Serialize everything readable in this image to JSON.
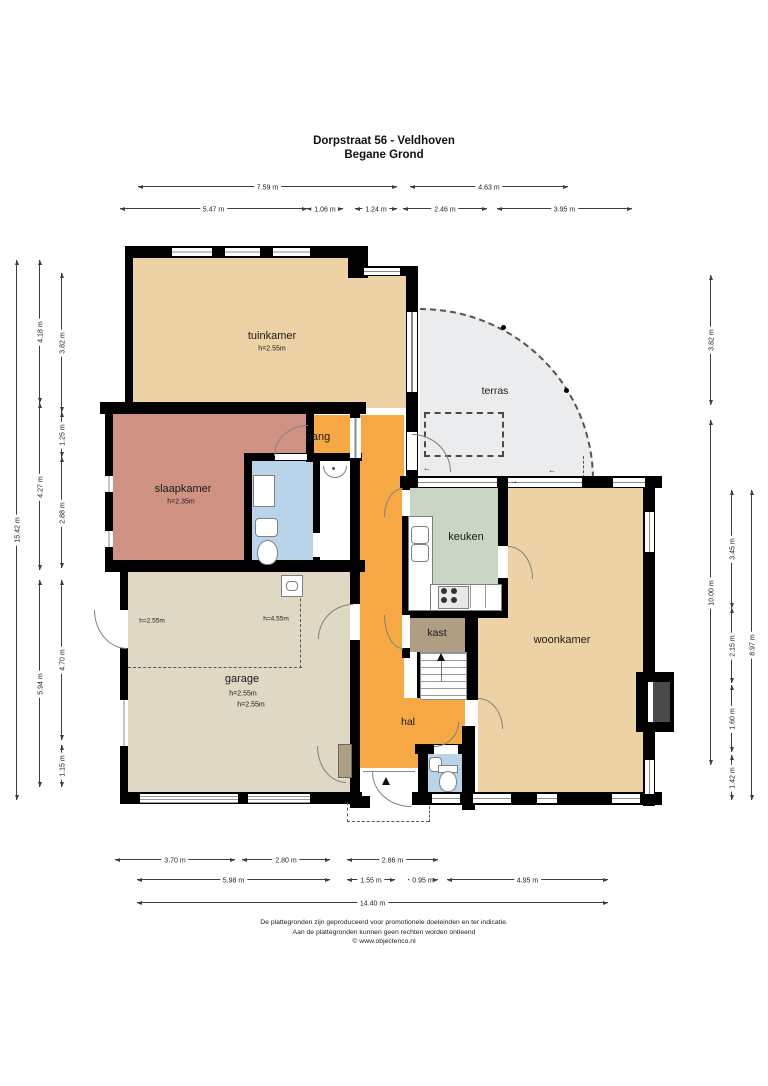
{
  "title": {
    "line1": "Dorpstraat 56 - Veldhoven",
    "line2": "Begane Grond"
  },
  "footer": {
    "line1": "De plattegronden zijn geproduceerd voor promotionele doeleinden en ter indicatie.",
    "line2": "Aan de plattegronden kunnen geen rechten worden ontleend",
    "line3": "© www.objectenco.nl"
  },
  "colors": {
    "beige": "#ecd2a4",
    "salmon": "#d09383",
    "orange": "#f5a844",
    "sage": "#cbd5c5",
    "greige": "#ded8c4",
    "brown": "#ae9f83",
    "blue": "#b9d4e9",
    "terras": "#ebecee",
    "wall": "#000000"
  },
  "plan": {
    "labels": [
      {
        "name": "room-label-tuinkamer",
        "text": "tuinkamer",
        "x": 272,
        "y": 336,
        "fs": 11
      },
      {
        "name": "room-height-tuinkamer",
        "text": "h=2.55m",
        "x": 272,
        "y": 349,
        "fs": 7
      },
      {
        "name": "room-label-terras",
        "text": "terras",
        "x": 495,
        "y": 391,
        "fs": 10.5
      },
      {
        "name": "room-label-gang",
        "text": "gang",
        "x": 318,
        "y": 437,
        "fs": 11
      },
      {
        "name": "room-label-slaapkamer",
        "text": "slaapkamer",
        "x": 183,
        "y": 489,
        "fs": 11
      },
      {
        "name": "room-height-slaapkamer",
        "text": "h=2.35m",
        "x": 181,
        "y": 502,
        "fs": 7
      },
      {
        "name": "room-label-keuken",
        "text": "keuken",
        "x": 466,
        "y": 537,
        "fs": 11
      },
      {
        "name": "room-label-kast",
        "text": "kast",
        "x": 437,
        "y": 633,
        "fs": 10.5
      },
      {
        "name": "room-label-woonkamer",
        "text": "woonkamer",
        "x": 562,
        "y": 640,
        "fs": 11
      },
      {
        "name": "room-label-garage",
        "text": "garage",
        "x": 242,
        "y": 679,
        "fs": 11
      },
      {
        "name": "room-height-garage-1",
        "text": "h=2.55m",
        "x": 243,
        "y": 694,
        "fs": 7
      },
      {
        "name": "room-height-garage-2",
        "text": "h=2.55m",
        "x": 251,
        "y": 705,
        "fs": 7
      },
      {
        "name": "zone-height-garage-left",
        "text": "h=2.55m",
        "x": 152,
        "y": 621,
        "fs": 6.5
      },
      {
        "name": "zone-height-garage-right",
        "text": "h=4.55m",
        "x": 276,
        "y": 619,
        "fs": 6.5
      },
      {
        "name": "room-label-hal",
        "text": "hal",
        "x": 408,
        "y": 722,
        "fs": 10.5
      },
      {
        "name": "slide-arrow",
        "text": "←",
        "x": 552,
        "y": 470,
        "fs": 8
      },
      {
        "name": "slide-arrow",
        "text": "→",
        "x": 514,
        "y": 481,
        "fs": 8
      },
      {
        "name": "slide-arrow",
        "text": "←",
        "x": 427,
        "y": 468,
        "fs": 8
      }
    ],
    "dimensions": [
      {
        "t": "7.59 m",
        "d": "h",
        "a": 138,
        "b": 397,
        "c": 186
      },
      {
        "t": "4.63 m",
        "d": "h",
        "a": 410,
        "b": 568,
        "c": 186
      },
      {
        "t": "5.47 m",
        "d": "h",
        "a": 120,
        "b": 307,
        "c": 208
      },
      {
        "t": "1.06 m",
        "d": "h",
        "a": 307,
        "b": 343,
        "c": 208
      },
      {
        "t": "1.24 m",
        "d": "h",
        "a": 355,
        "b": 397,
        "c": 208
      },
      {
        "t": "2.46 m",
        "d": "h",
        "a": 403,
        "b": 487,
        "c": 208
      },
      {
        "t": "3.95 m",
        "d": "h",
        "a": 497,
        "b": 632,
        "c": 208
      },
      {
        "t": "15.42 m",
        "d": "v",
        "a": 260,
        "b": 800,
        "c": 16
      },
      {
        "t": "4.18 m",
        "d": "v",
        "a": 260,
        "b": 403,
        "c": 39
      },
      {
        "t": "4.27 m",
        "d": "v",
        "a": 403,
        "b": 570,
        "c": 39
      },
      {
        "t": "5.94 m",
        "d": "v",
        "a": 580,
        "b": 787,
        "c": 39
      },
      {
        "t": "3.82 m",
        "d": "v",
        "a": 273,
        "b": 412,
        "c": 61
      },
      {
        "t": "1.25 m",
        "d": "v",
        "a": 412,
        "b": 457,
        "c": 61
      },
      {
        "t": "2.88 m",
        "d": "v",
        "a": 457,
        "b": 568,
        "c": 61
      },
      {
        "t": "4.70 m",
        "d": "v",
        "a": 580,
        "b": 740,
        "c": 61
      },
      {
        "t": "1.15 m",
        "d": "v",
        "a": 745,
        "b": 787,
        "c": 61
      },
      {
        "t": "3.82 m",
        "d": "v",
        "a": 275,
        "b": 405,
        "c": 710
      },
      {
        "t": "10.00 m",
        "d": "v",
        "a": 420,
        "b": 765,
        "c": 710
      },
      {
        "t": "3.45 m",
        "d": "v",
        "a": 490,
        "b": 608,
        "c": 731
      },
      {
        "t": "2.15 m",
        "d": "v",
        "a": 608,
        "b": 683,
        "c": 731
      },
      {
        "t": "1.60 m",
        "d": "v",
        "a": 685,
        "b": 752,
        "c": 731
      },
      {
        "t": "1.42 m",
        "d": "v",
        "a": 755,
        "b": 800,
        "c": 731
      },
      {
        "t": "8.97 m",
        "d": "v",
        "a": 490,
        "b": 800,
        "c": 751
      },
      {
        "t": "3.70 m",
        "d": "h",
        "a": 115,
        "b": 235,
        "c": 859
      },
      {
        "t": "2.80 m",
        "d": "h",
        "a": 242,
        "b": 330,
        "c": 859
      },
      {
        "t": "2.86 m",
        "d": "h",
        "a": 347,
        "b": 438,
        "c": 859
      },
      {
        "t": "5.98 m",
        "d": "h",
        "a": 137,
        "b": 330,
        "c": 879
      },
      {
        "t": "1.55 m",
        "d": "h",
        "a": 347,
        "b": 395,
        "c": 879
      },
      {
        "t": "0.95 m",
        "d": "h",
        "a": 408,
        "b": 438,
        "c": 879
      },
      {
        "t": "4.95 m",
        "d": "h",
        "a": 447,
        "b": 608,
        "c": 879
      },
      {
        "t": "14.40 m",
        "d": "h",
        "a": 137,
        "b": 608,
        "c": 902
      }
    ]
  }
}
